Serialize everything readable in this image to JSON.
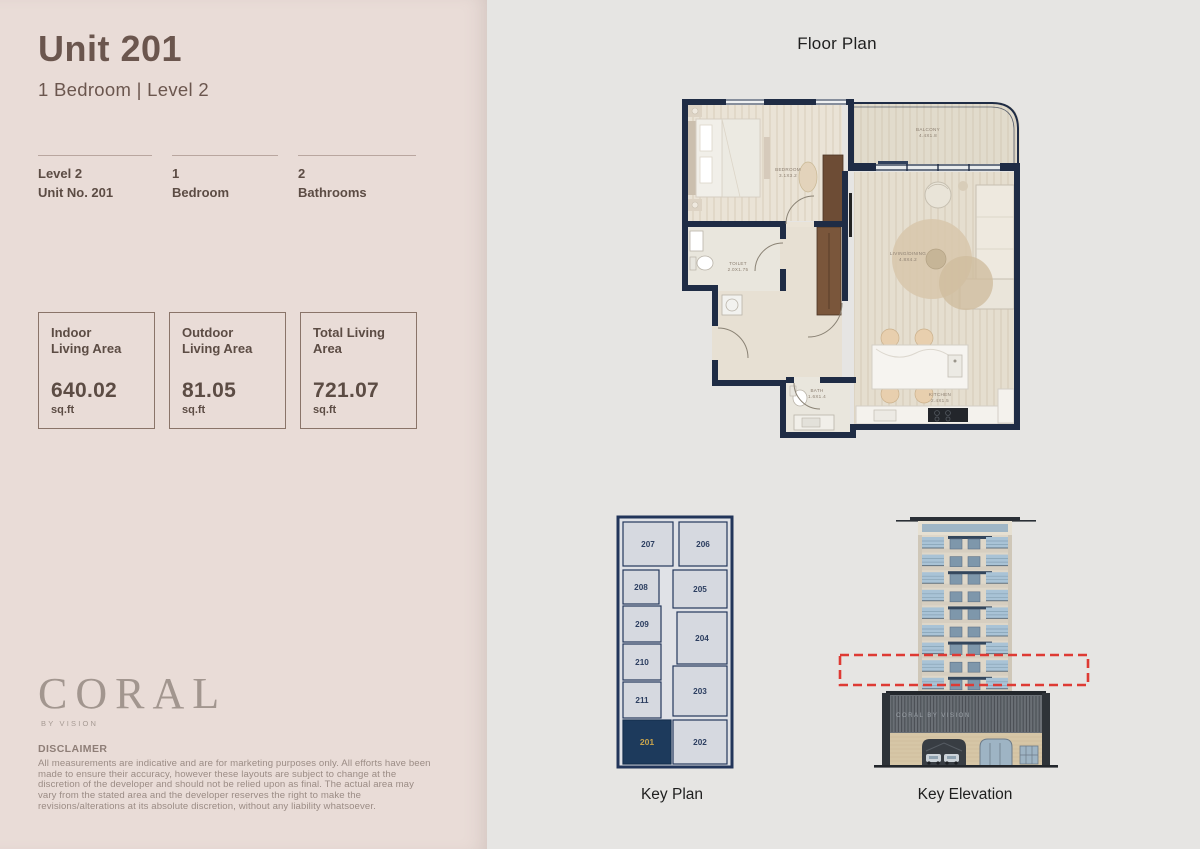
{
  "left_panel": {
    "title": "Unit 201",
    "subtitle": "1 Bedroom  |  Level 2",
    "stats": [
      {
        "line1": "Level 2",
        "line2": "Unit No. 201"
      },
      {
        "line1": "1",
        "line2": "Bedroom"
      },
      {
        "line1": "2",
        "line2": "Bathrooms"
      }
    ],
    "area_boxes": [
      {
        "label": "Indoor\nLiving Area",
        "value": "640.02",
        "unit": "sq.ft"
      },
      {
        "label": "Outdoor\nLiving Area",
        "value": "81.05",
        "unit": "sq.ft"
      },
      {
        "label": "Total Living\nArea",
        "value": "721.07",
        "unit": "sq.ft"
      }
    ],
    "brand": {
      "name": "CORAL",
      "tagline": "BY VISION"
    },
    "disclaimer": {
      "heading": "DISCLAIMER",
      "body": "All measurements are indicative and are for marketing purposes only. All efforts have been made to ensure their accuracy, however these layouts are subject to change at the discretion of the developer and should not be relied upon as final. The actual area may vary from the stated area and the developer reserves the right to make the revisions/alterations at its absolute discretion, without any liability whatsoever."
    }
  },
  "floor_plan": {
    "title": "Floor Plan",
    "rooms": [
      {
        "name": "BEDROOM",
        "dims": "3.1X3.2"
      },
      {
        "name": "BALCONY",
        "dims": "4.4X1.8"
      },
      {
        "name": "LIVING/DINING",
        "dims": "4.8X4.2"
      },
      {
        "name": "TOILET",
        "dims": "2.0X1.75"
      },
      {
        "name": "BATH",
        "dims": "1.6X1.4"
      },
      {
        "name": "KITCHEN",
        "dims": "2.4X1.5"
      }
    ]
  },
  "key_plan": {
    "caption": "Key Plan",
    "highlighted_unit": "201",
    "units": [
      {
        "no": "207"
      },
      {
        "no": "208"
      },
      {
        "no": "209"
      },
      {
        "no": "210"
      },
      {
        "no": "211"
      },
      {
        "no": "201"
      },
      {
        "no": "206"
      },
      {
        "no": "205"
      },
      {
        "no": "204"
      },
      {
        "no": "203"
      },
      {
        "no": "202"
      }
    ]
  },
  "key_elevation": {
    "caption": "Key Elevation",
    "building_sign": "CORAL BY VISION"
  },
  "colors": {
    "left_bg": "#e9dcd7",
    "right_bg": "#e6e5e3",
    "heading": "#6b564e",
    "navy": "#1f2c45",
    "keyplan_navy": "#1d3a5c",
    "gold": "#c7a34a",
    "highlight_red": "#de3a34"
  }
}
